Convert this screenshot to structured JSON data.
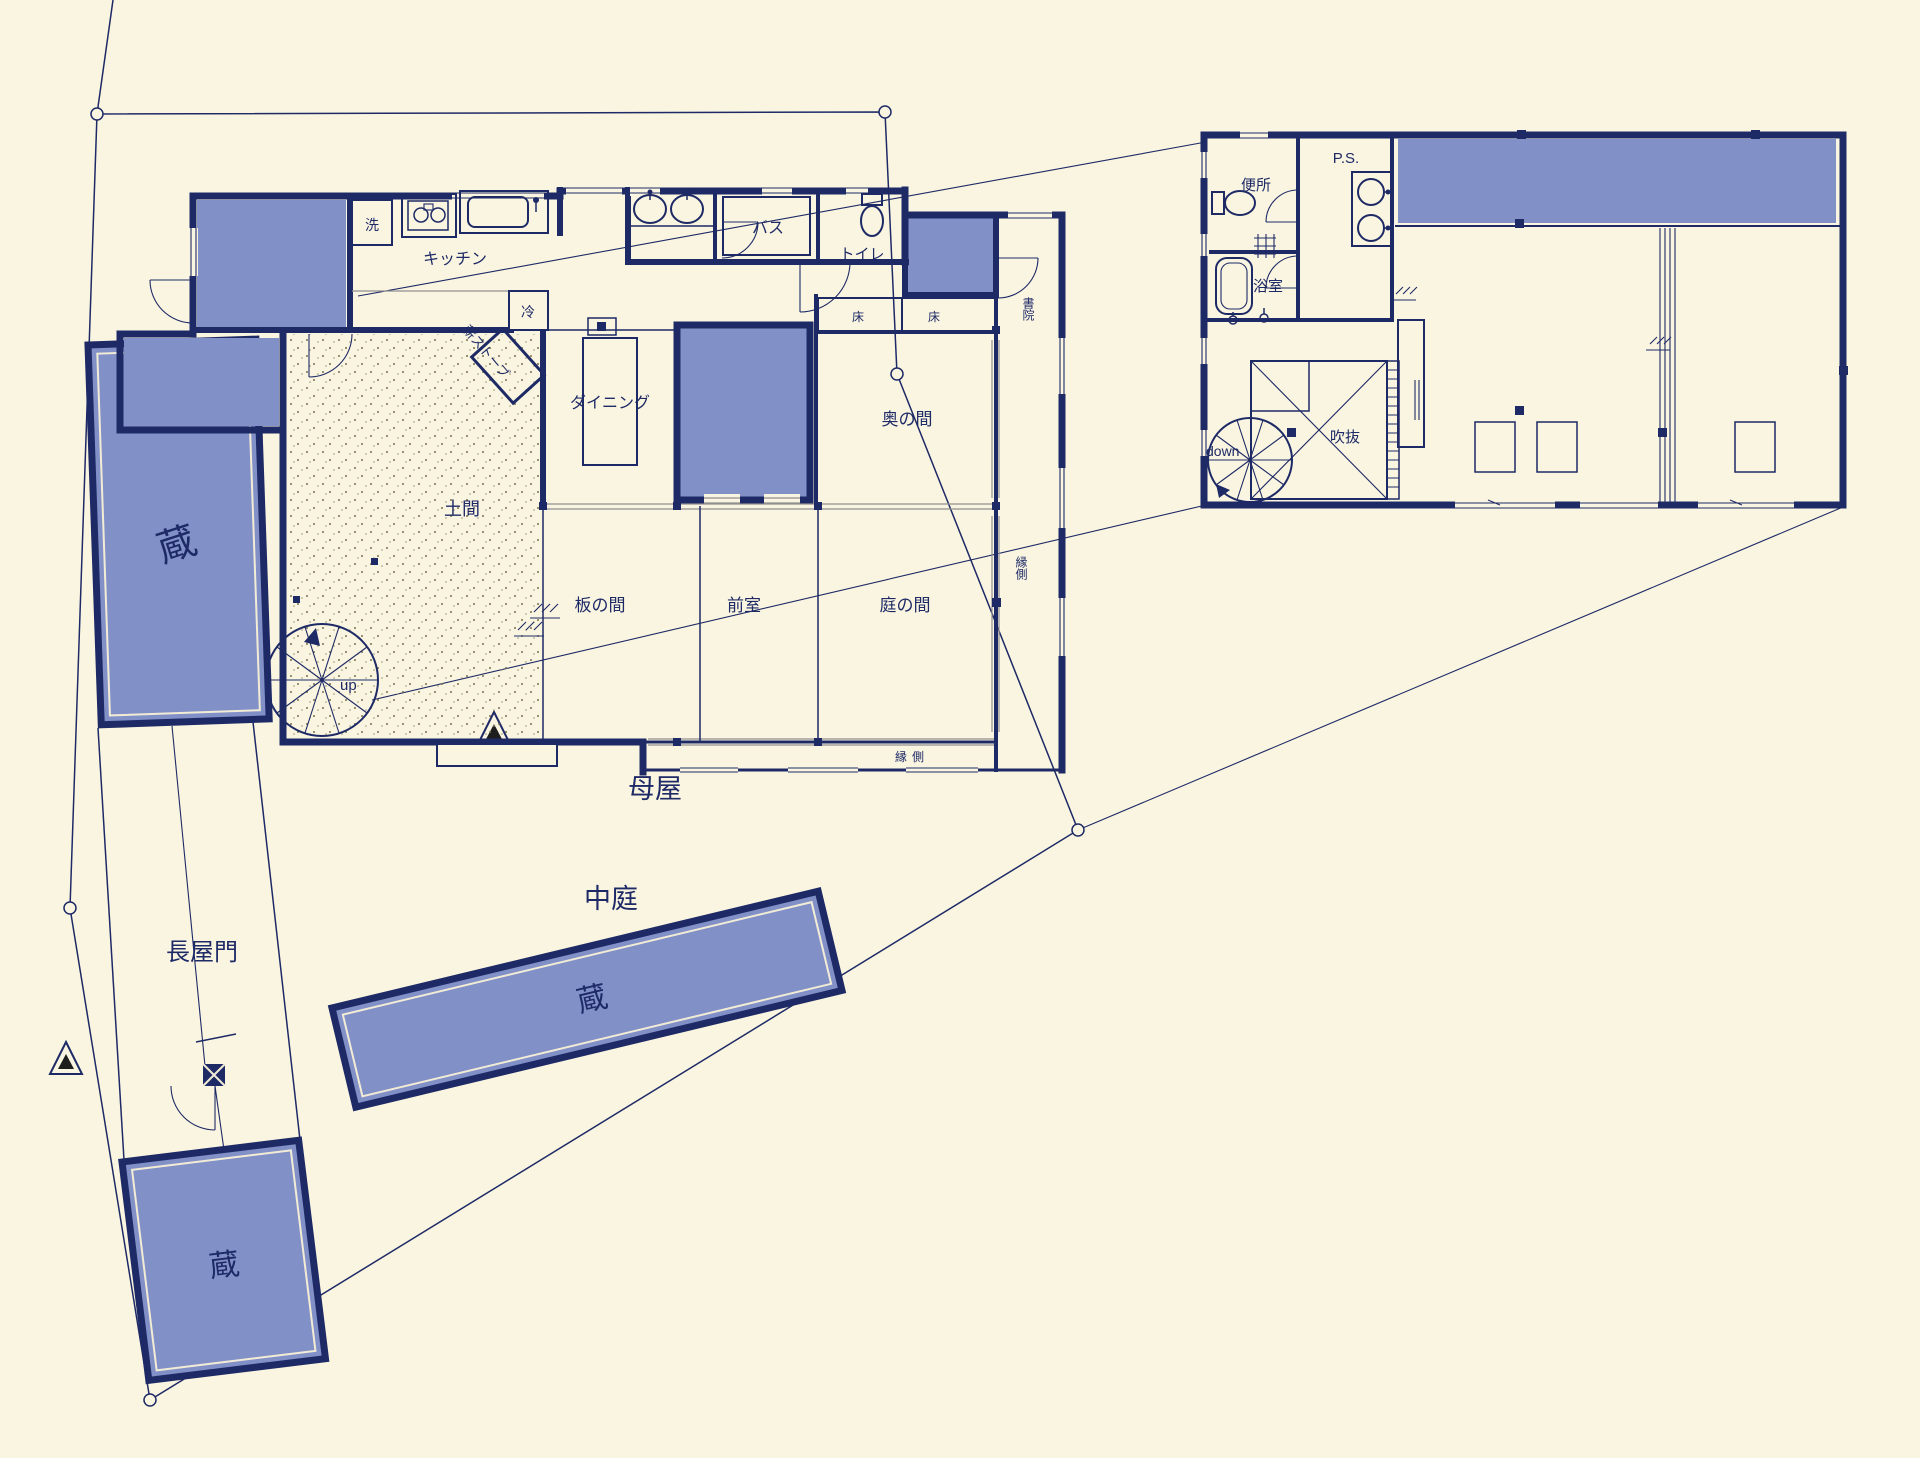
{
  "colors": {
    "background": "#faf5e1",
    "wall_navy": "#1e2a66",
    "room_fill_blue": "#8191c8",
    "sliding_track_gray": "#8f8f8f"
  },
  "site": {
    "omoya": "母屋",
    "nakaniwa": "中庭",
    "nagayamon": "長屋門",
    "kura_west": "蔵",
    "kura_southwest": "蔵",
    "kura_south": "蔵"
  },
  "f1": {
    "kitchen": "キッチン",
    "wash": "洗",
    "fridge": "冷",
    "bath": "バス",
    "toilet": "トイレ",
    "dining": "ダイニング",
    "doma": "土間",
    "itanoma": "板の間",
    "zenshitsu": "前室",
    "okunoma": "奥の間",
    "niwanoma": "庭の間",
    "toko_left": "床",
    "toko_right": "床",
    "shoin": "書院",
    "engawa_east": "縁側",
    "engawa_south": "縁側",
    "wood_stove": "薪ストーブ",
    "stair_up": "up"
  },
  "f2": {
    "benjo": "便所",
    "ps": "P.S.",
    "yokushitsu": "浴室",
    "fukinuke": "吹抜",
    "stair_down": "down"
  }
}
